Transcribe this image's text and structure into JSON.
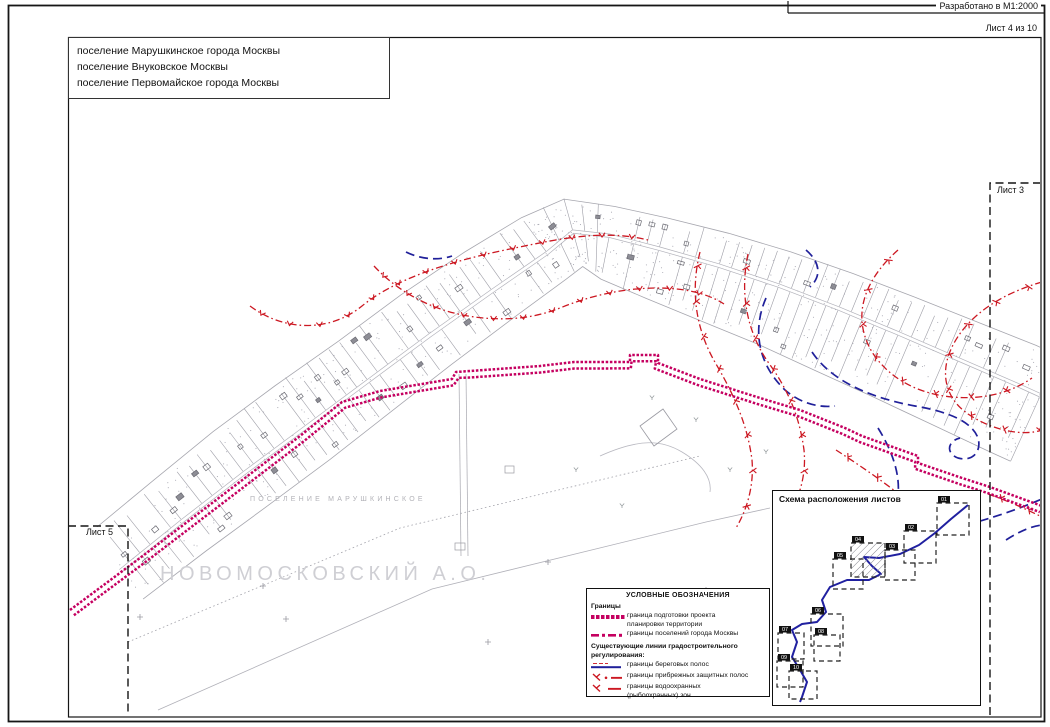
{
  "page": {
    "developed_label": "Разработано в  М1:2000",
    "sheet_label": "Лист 4 из 10"
  },
  "note": {
    "line1": "поселение Марушкинское города Москвы",
    "line2": "поселение Внуковское Москвы",
    "line3": "поселение Первомайское города Москвы"
  },
  "map": {
    "band_label": "ПОСЕЛЕНИЕ МАРУШКИНСКОЕ",
    "district_label": "НОВОМОСКОВСКИЙ А.О.",
    "sheet_left": "Лист 5",
    "sheet_right": "Лист 3"
  },
  "legend": {
    "title": "УСЛОВНЫЕ ОБОЗНАЧЕНИЯ",
    "group1": "Границы",
    "item1_line1": "граница подготовки проекта",
    "item1_line2": "планировки территории",
    "item2": "границы поселений города Москвы",
    "group2_line1": "Существующие линии градостроительного",
    "group2_line2": "регулирования:",
    "item3": "границы береговых полос",
    "item4": "границы прибрежных защитных полос",
    "item5_line1": "границы водоохранных",
    "item5_line2": "(рыбоохранных) зон"
  },
  "inset": {
    "title": "Схема расположения листов",
    "sheets": [
      "01",
      "02",
      "03",
      "04",
      "05",
      "06",
      "07",
      "08",
      "09",
      "10"
    ],
    "current_sheet": "04"
  },
  "colors": {
    "boundary_magenta": "#c50060",
    "regulation_red": "#cc1822",
    "shore_blue": "#20209a",
    "parcel_gray": "#9a9aa2",
    "frame": "#1a1a1a"
  }
}
